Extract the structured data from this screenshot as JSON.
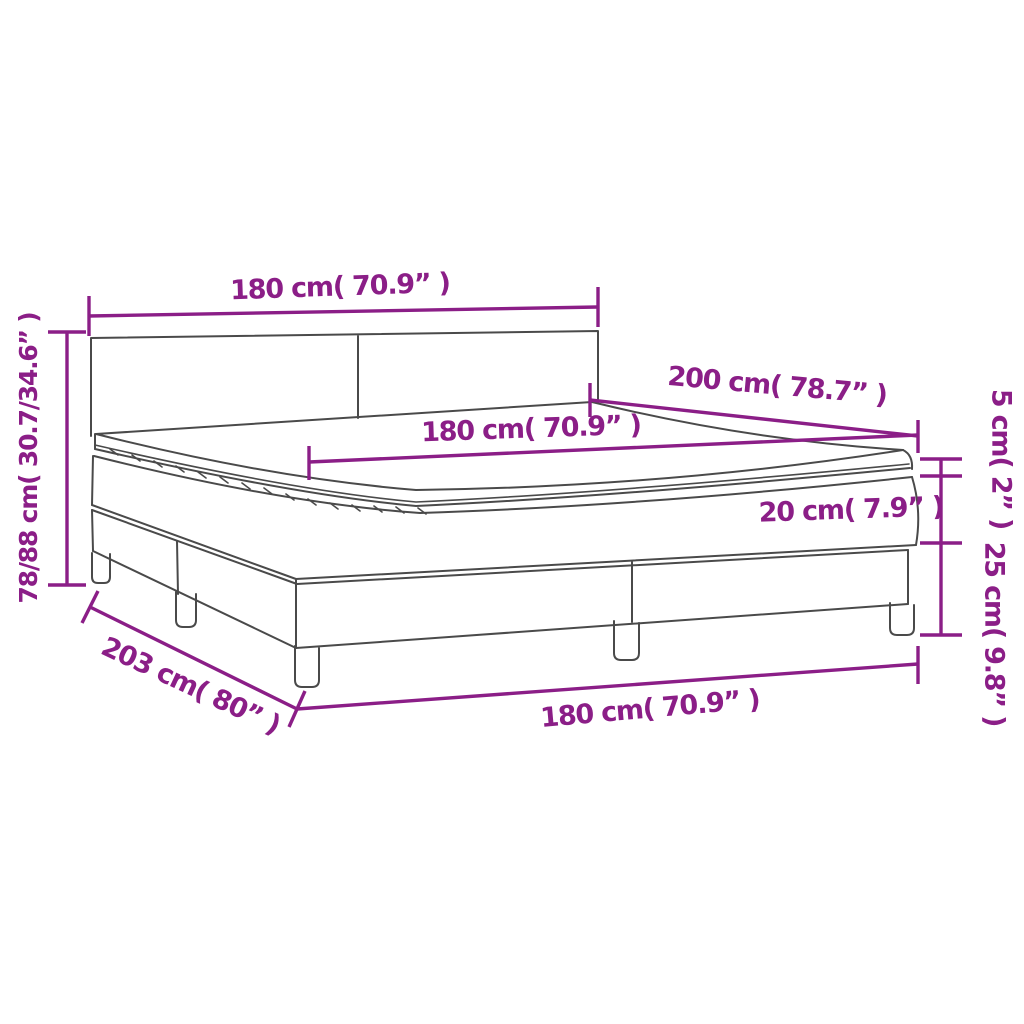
{
  "diagram": {
    "name": "box-spring-bed-dimension-diagram",
    "colors": {
      "dimension_accent": "#8B1E87",
      "drawing_outline": "#4a4a4a",
      "background": "#ffffff"
    },
    "labels": {
      "headboard_width": "180 cm( 70.9” )",
      "overall_height": "78/88 cm( 30.7/34.6” )",
      "bed_length": "200 cm( 78.7” )",
      "mattress_width": "180 cm( 70.9” )",
      "topper_thickness": "5 cm( 2” )",
      "mattress_thickness": "20 cm( 7.9” )",
      "base_height": "25 cm( 9.8” )",
      "base_length": "203 cm( 80” )",
      "base_width": "180 cm( 70.9” )"
    },
    "measurements": [
      {
        "part": "headboard width",
        "cm": "180",
        "inches": "70.9"
      },
      {
        "part": "overall height",
        "cm": "78/88",
        "inches": "30.7/34.6"
      },
      {
        "part": "bed length",
        "cm": "200",
        "inches": "78.7"
      },
      {
        "part": "mattress width",
        "cm": "180",
        "inches": "70.9"
      },
      {
        "part": "topper thickness",
        "cm": "5",
        "inches": "2"
      },
      {
        "part": "mattress thickness",
        "cm": "20",
        "inches": "7.9"
      },
      {
        "part": "base height with legs",
        "cm": "25",
        "inches": "9.8"
      },
      {
        "part": "base length",
        "cm": "203",
        "inches": "80"
      },
      {
        "part": "base width",
        "cm": "180",
        "inches": "70.9"
      }
    ]
  }
}
